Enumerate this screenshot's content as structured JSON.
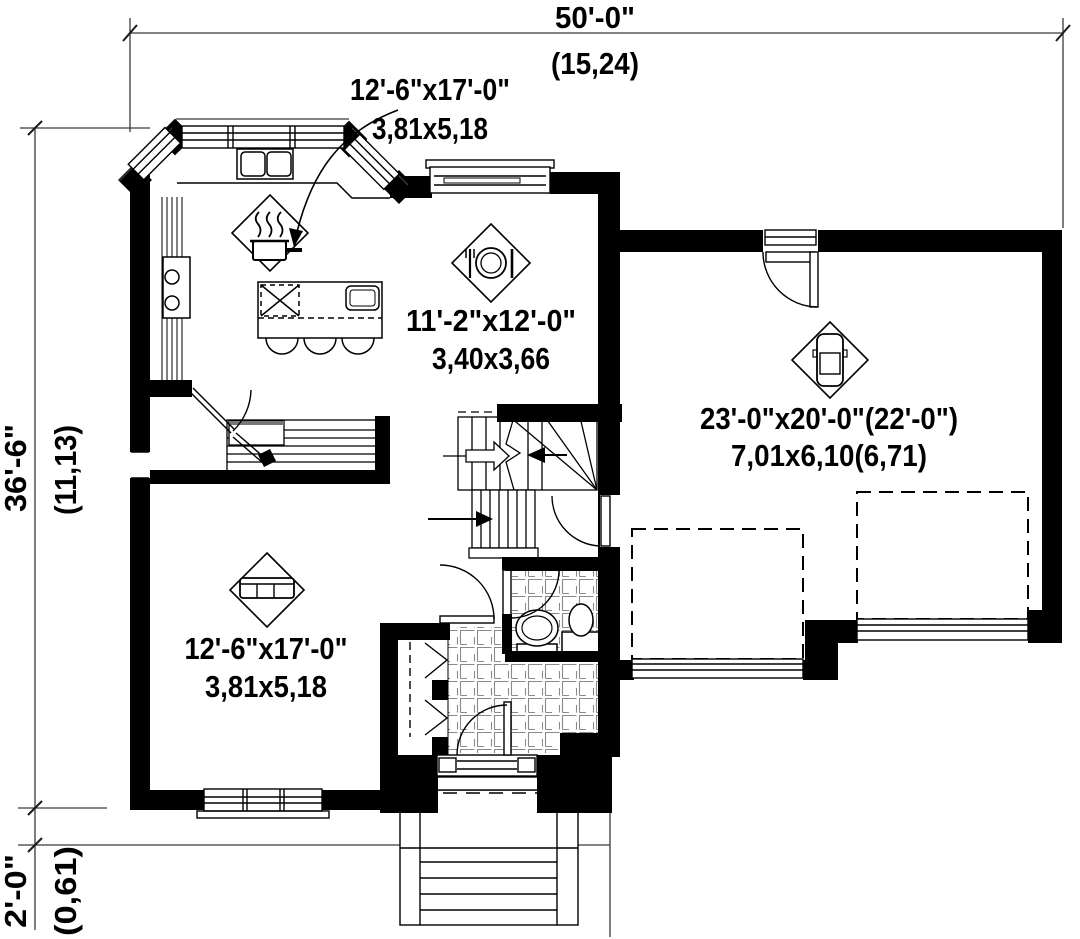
{
  "title": "House first-floor plan",
  "dimensions": {
    "top": {
      "imperial": "50'-0\"",
      "metric": "(15,24)"
    },
    "left": {
      "imperial": "36'-6\"",
      "metric": "(11,13)"
    },
    "bottom_left": {
      "imperial": "2'-0\"",
      "metric": "(0,61)"
    }
  },
  "rooms": {
    "kitchen": {
      "imperial": "12'-6\"x17'-0\"",
      "metric": "3,81x5,18",
      "icon": "cooking-pot-icon"
    },
    "dining": {
      "imperial": "11'-2\"x12'-0\"",
      "metric": "3,40x3,66",
      "icon": "plate-cutlery-icon"
    },
    "garage": {
      "imperial": "23'-0\"x20'-0\"(22'-0\")",
      "metric": "7,01x6,10(6,71)",
      "icon": "car-icon"
    },
    "living": {
      "imperial": "12'-6\"x17'-0\"",
      "metric": "3,81x5,18",
      "icon": "sofa-icon"
    }
  },
  "colors": {
    "wall": "#000000",
    "background": "#ffffff",
    "dimension_line": "#3a3a3a",
    "tile_line": "#8a8a8a"
  }
}
